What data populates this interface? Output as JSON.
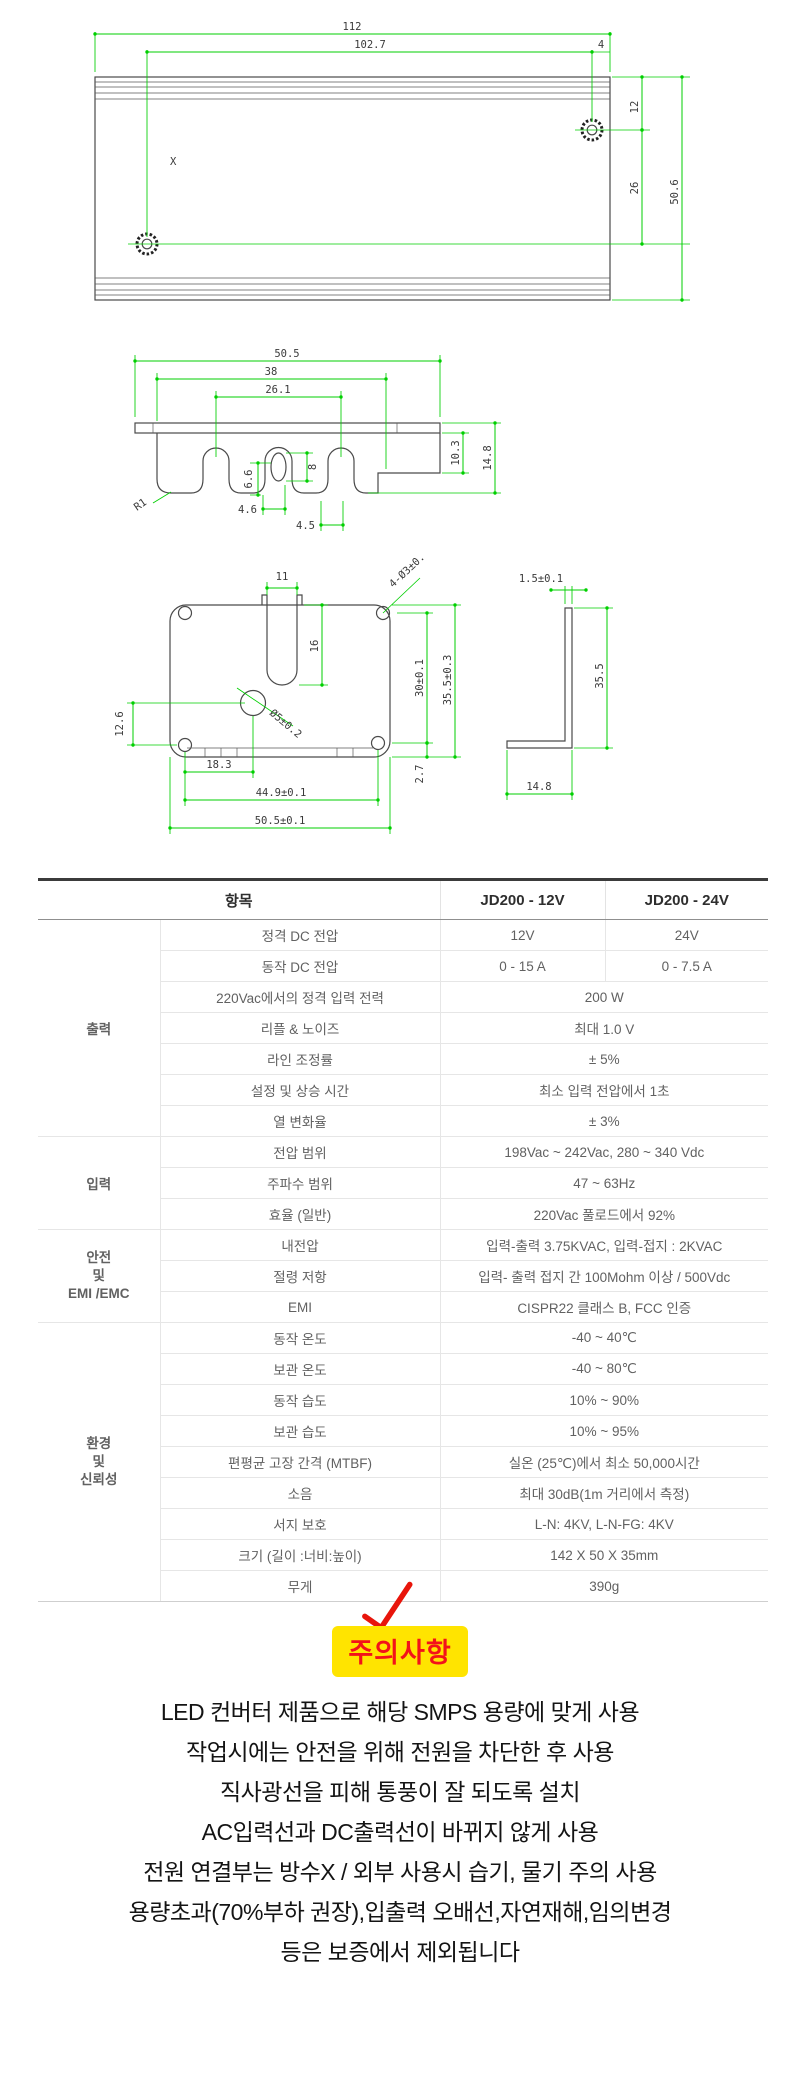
{
  "colors": {
    "dimension_line": "#00cf00",
    "part_line": "#4a4a4a",
    "badge_bg": "#ffe400",
    "badge_text": "#f3121a",
    "check_mark": "#e8150b"
  },
  "drawings": {
    "top_view": {
      "part_label": "X",
      "dim_112": "112",
      "dim_102_7": "102.7",
      "dim_4": "4",
      "dim_12": "12",
      "dim_26": "26",
      "dim_50_6": "50.6"
    },
    "front_view": {
      "dim_50_5": "50.5",
      "dim_38": "38",
      "dim_26_1": "26.1",
      "dim_r1": "R1",
      "dim_6_6": "6.6",
      "dim_8": "8",
      "dim_4_6": "4.6",
      "dim_4_5": "4.5",
      "dim_10_3": "10.3",
      "dim_14_8": "14.8"
    },
    "face_view": {
      "dim_11": "11",
      "dim_holes": "4-Ø3±0.1",
      "dim_16": "16",
      "dim_30": "30±0.1",
      "dim_35_5": "35.5±0.3",
      "dim_hole5": "Ø5±0.2",
      "dim_12_6": "12.6",
      "dim_18_3": "18.3",
      "dim_2_7": "2.7",
      "dim_44_9": "44.9±0.1",
      "dim_50_5": "50.5±0.1"
    },
    "side_view": {
      "dim_1_5": "1.5±0.1",
      "dim_35_5": "35.5",
      "dim_14_8": "14.8"
    }
  },
  "spec_table": {
    "header": {
      "item": "항목",
      "model1": "JD200 - 12V",
      "model2": "JD200 - 24V"
    },
    "group_labels": {
      "output": "출력",
      "input": "입력",
      "safety": [
        "안전",
        "및",
        "EMI /EMC"
      ],
      "environment": [
        "환경",
        "및",
        "신뢰성"
      ]
    },
    "rows": [
      {
        "label": "정격 DC 전압",
        "v1": "12V",
        "v2": "24V"
      },
      {
        "label": "동작 DC 전압",
        "v1": "0 - 15 A",
        "v2": "0 - 7.5 A"
      },
      {
        "label": "220Vac에서의 정격 입력 전력",
        "value": "200 W"
      },
      {
        "label": "리플 & 노이즈",
        "value": "최대 1.0 V"
      },
      {
        "label": "라인 조정률",
        "value": "± 5%"
      },
      {
        "label": "설정 및 상승 시간",
        "value": "최소 입력 전압에서 1초"
      },
      {
        "label": "열 변화율",
        "value": "± 3%"
      },
      {
        "label": "전압 범위",
        "value": "198Vac ~ 242Vac, 280 ~ 340 Vdc"
      },
      {
        "label": "주파수 범위",
        "value": "47 ~ 63Hz"
      },
      {
        "label": "효율 (일반)",
        "value": "220Vac 풀로드에서 92%"
      },
      {
        "label": "내전압",
        "value": "입력-출력 3.75KVAC, 입력-접지 : 2KVAC"
      },
      {
        "label": "절령 저항",
        "value": "입력- 출력 접지 간 100Mohm 이상 / 500Vdc"
      },
      {
        "label": "EMI",
        "value": "CISPR22 클래스 B, FCC 인증"
      },
      {
        "label": "동작 온도",
        "value": "-40 ~ 40℃"
      },
      {
        "label": "보관 온도",
        "value": "-40 ~ 80℃"
      },
      {
        "label": "동작 습도",
        "value": "10% ~ 90%"
      },
      {
        "label": "보관 습도",
        "value": "10% ~ 95%"
      },
      {
        "label": "편평균 고장 간격 (MTBF)",
        "value": "실온 (25℃)에서 최소 50,000시간"
      },
      {
        "label": "소음",
        "value": "최대 30dB(1m 거리에서 측정)"
      },
      {
        "label": "서지 보호",
        "value": "L-N: 4KV, L-N-FG: 4KV"
      },
      {
        "label": "크기 (길이 :너비:높이)",
        "value": "142 X 50 X 35mm"
      },
      {
        "label": "무게",
        "value": "390g"
      }
    ]
  },
  "caution": {
    "badge": "주의사항",
    "lines": [
      "LED 컨버터 제품으로 해당 SMPS 용량에 맞게 사용",
      "작업시에는 안전을 위해 전원을 차단한 후 사용",
      "직사광선을 피해 통풍이 잘 되도록 설치",
      "AC입력선과 DC출력선이 바뀌지 않게 사용",
      "전원 연결부는 방수X / 외부 사용시 습기, 물기 주의 사용",
      "용량초과(70%부하 권장),입출력 오배선,자연재해,임의변경",
      "등은 보증에서 제외됩니다"
    ]
  }
}
